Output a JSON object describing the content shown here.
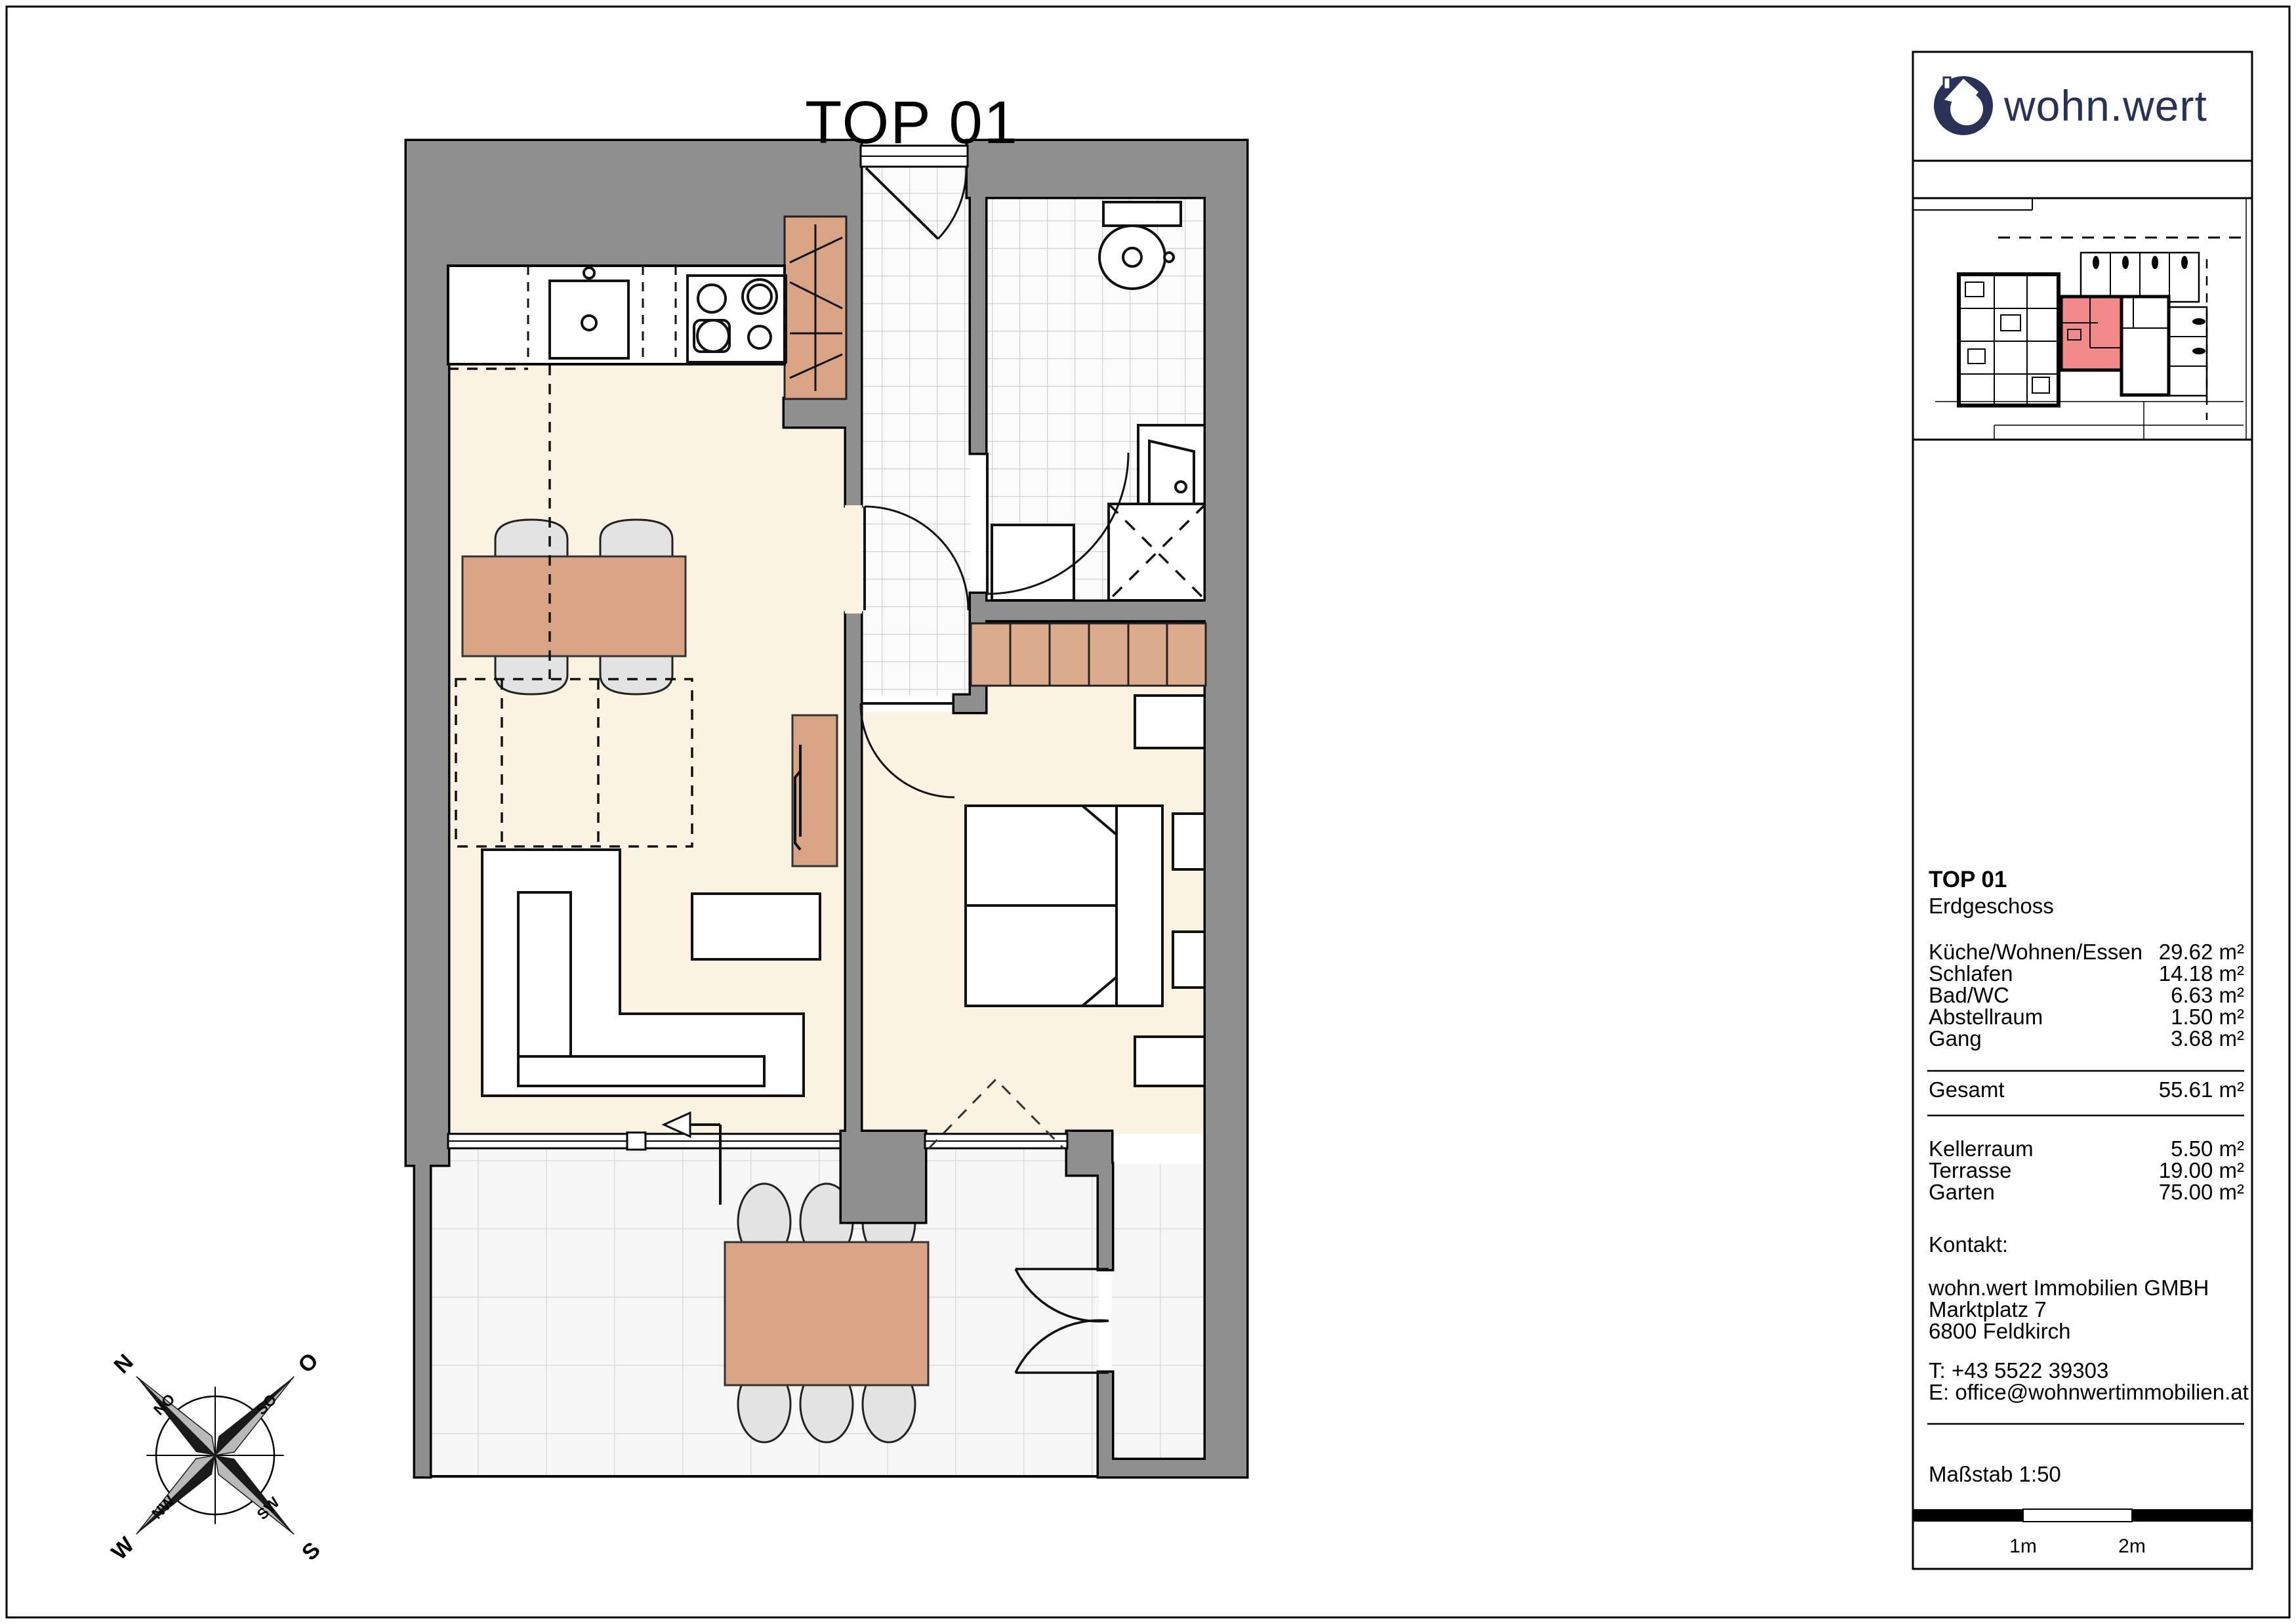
{
  "title": "TOP 01",
  "logo": {
    "text": "wohn.wert"
  },
  "panel": {
    "unit_heading": "TOP 01",
    "unit_floor": "Erdgeschoss",
    "rooms": [
      {
        "label": "Küche/Wohnen/Essen",
        "area": "29.62 m²"
      },
      {
        "label": "Schlafen",
        "area": "14.18 m²"
      },
      {
        "label": "Bad/WC",
        "area": "6.63 m²"
      },
      {
        "label": "Abstellraum",
        "area": "1.50 m²"
      },
      {
        "label": "Gang",
        "area": "3.68 m²"
      }
    ],
    "total": {
      "label": "Gesamt",
      "area": "55.61 m²"
    },
    "outdoor": [
      {
        "label": "Kellerraum",
        "area": "5.50 m²"
      },
      {
        "label": "Terrasse",
        "area": "19.00 m²"
      },
      {
        "label": "Garten",
        "area": "75.00 m²"
      }
    ],
    "contact": {
      "heading": "Kontakt:",
      "company": "wohn.wert Immobilien GMBH",
      "street": "Marktplatz 7",
      "city": "6800 Feldkirch",
      "phone": "T: +43 5522 39303",
      "email": "E: office@wohnwertimmobilien.at"
    },
    "scale": {
      "label": "Maßstab 1:50",
      "tick1": "1m",
      "tick2": "2m"
    }
  },
  "compass": {
    "n": "N",
    "no": "NO",
    "o": "O",
    "so": "SO",
    "s": "S",
    "sw": "SW",
    "w": "W",
    "nw": "NW"
  },
  "colors": {
    "wall": "#8f8f8f",
    "floor_cream": "#fcf3e2",
    "furniture_brown": "#d9a486",
    "logo_navy": "#2a3157",
    "unit_red": "#f28a8a",
    "chair_gray": "#e3e3e3"
  }
}
